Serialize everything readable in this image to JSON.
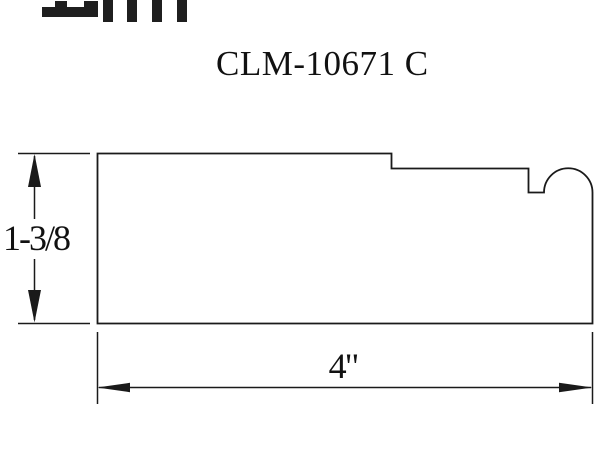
{
  "title": "CLM-10671 C",
  "dimensions": {
    "height_label": "1-3/8",
    "width_label": "4\""
  },
  "colors": {
    "ink": "#1a1a1a",
    "background": "#ffffff"
  }
}
